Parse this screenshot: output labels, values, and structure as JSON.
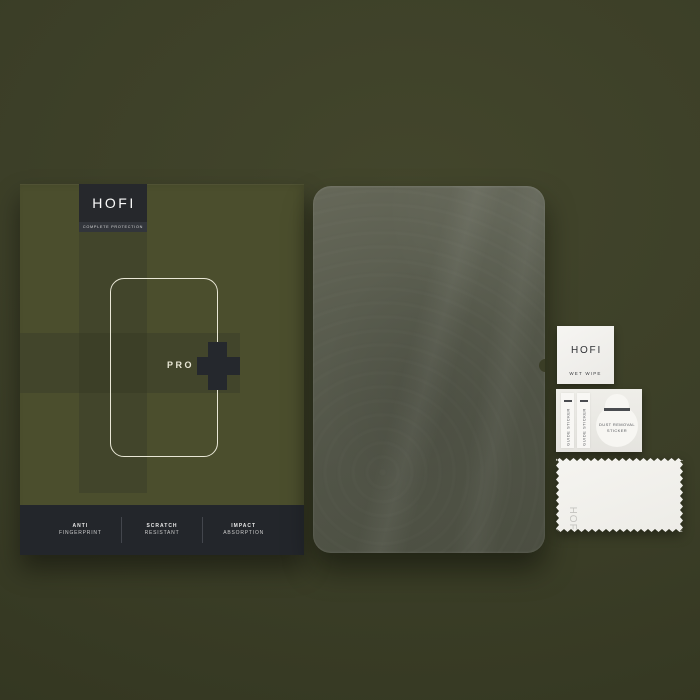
{
  "background_color": "#3b3e27",
  "box": {
    "logo": "HOFI",
    "tagline": "COMPLETE PROTECTION",
    "model": "PRO",
    "features": [
      {
        "line1": "ANTI",
        "line2": "FINGERPRINT"
      },
      {
        "line1": "SCRATCH",
        "line2": "RESISTANT"
      },
      {
        "line1": "IMPACT",
        "line2": "ABSORPTION"
      }
    ],
    "face_color": "#4b4e2d",
    "panel_color": "#23262b",
    "accent_color": "#e9e7d6",
    "badge_color": "#26282c"
  },
  "glass": {
    "tint_color": "#53564a"
  },
  "accessories": {
    "wet_wipe": {
      "brand": "HOFI",
      "label": "WET WIPE"
    },
    "guide_sticker": {
      "label": "GUIDE STICKER"
    },
    "dust_removal": {
      "line1": "DUST REMOVAL",
      "line2": "STICKER"
    },
    "cloth": {
      "brand": "HOFI"
    }
  }
}
